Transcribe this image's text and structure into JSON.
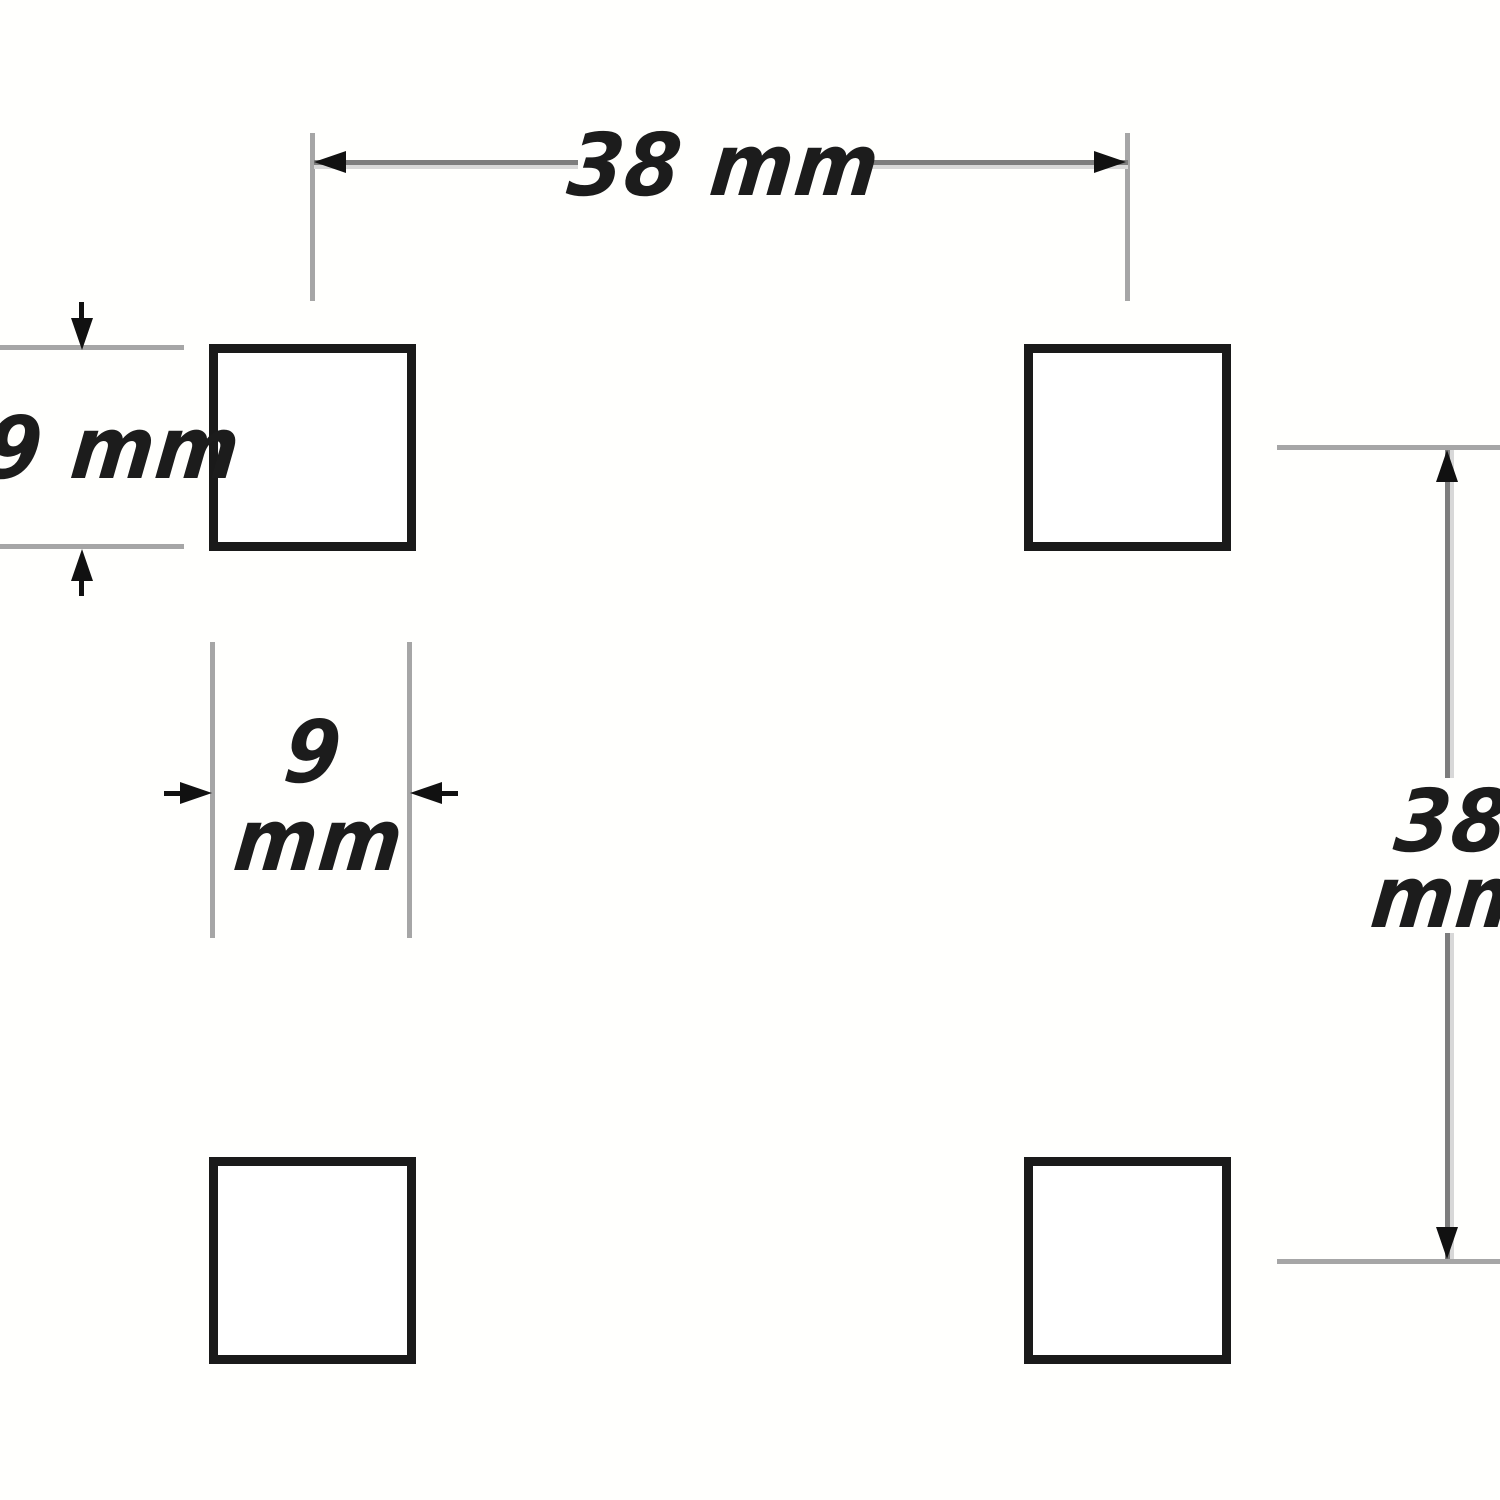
{
  "diagram": {
    "type": "dimensioned-drawing",
    "background": "#fffffd",
    "colors": {
      "background": "#fffffd",
      "ext_line": "#a6a6a6",
      "dim_line": "#7d7d7d",
      "dim_line_edge": "#d8d8d8",
      "arrow": "#111111",
      "square_border": "#1a1a1a",
      "square_fill": "#ffffff",
      "text": "#1c1c1c"
    },
    "squares": [
      {
        "id": "top-left"
      },
      {
        "id": "top-right"
      },
      {
        "id": "bottom-left"
      },
      {
        "id": "bottom-right"
      }
    ],
    "dimensions": {
      "horizontal_spacing": {
        "label": "38 mm"
      },
      "square_height": {
        "label": "9 mm"
      },
      "square_width": {
        "value": "9",
        "unit": "mm"
      },
      "vertical_spacing": {
        "value": "38",
        "unit": "mm"
      }
    }
  }
}
